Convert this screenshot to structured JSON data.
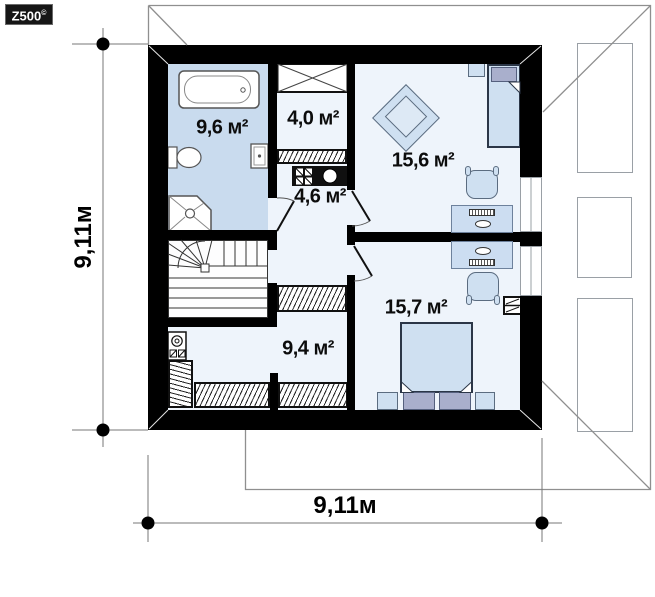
{
  "meta": {
    "brand": "Z500",
    "brand_sup": "©"
  },
  "dimensions": {
    "bottom_width": "9,11м",
    "left_height": "9,11м"
  },
  "rooms": [
    {
      "id": "bathroom",
      "area": "9,6 м²"
    },
    {
      "id": "wardrobe-room",
      "area": "4,0 м²"
    },
    {
      "id": "hall",
      "area": "4,6 м²"
    },
    {
      "id": "bedroom-upper-right",
      "area": "15,6 м²"
    },
    {
      "id": "bedroom-lower-right",
      "area": "15,7 м²"
    },
    {
      "id": "room-lower-left",
      "area": "9,4 м²"
    }
  ],
  "colors": {
    "wall": "#000000",
    "bathroom_floor": "#c9dbee",
    "room_floor": "#eef4fb",
    "furniture_fill": "#cfe0f1",
    "pillow_fill": "#a9afcc",
    "roof_line": "#8f8f8f"
  }
}
